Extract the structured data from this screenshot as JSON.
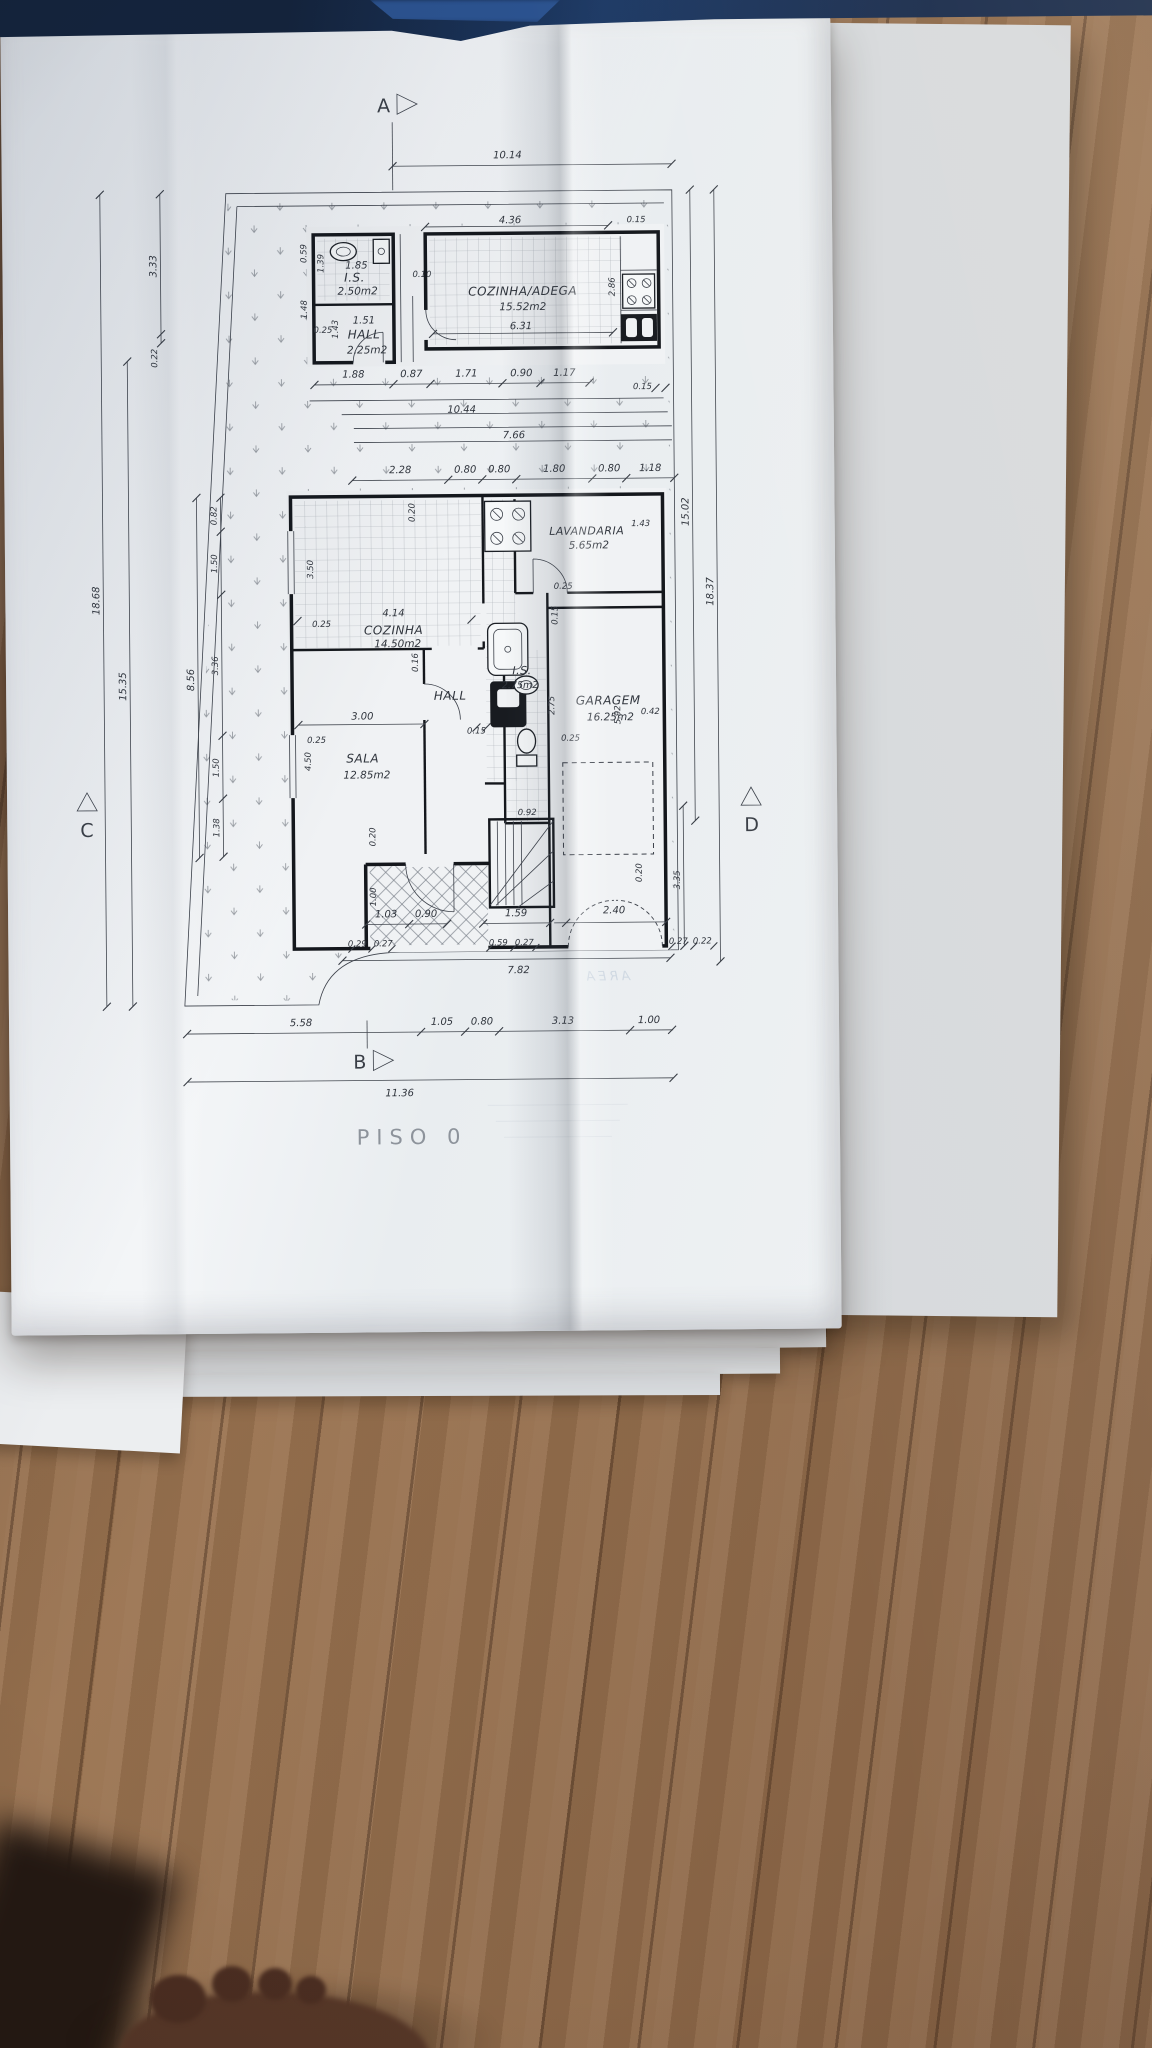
{
  "photo": {
    "cloth_color": "#1d3a66",
    "wood_color": "#936b4a",
    "paper_color": "#eef1f4",
    "ink_color": "#2e333b"
  },
  "plan": {
    "title": "PISO  0",
    "bleed_text": "AREA",
    "markers": {
      "top": "A",
      "bottom": "B",
      "left": "C",
      "right": "D"
    },
    "rooms": {
      "is_upper": {
        "name": "I.S.",
        "area": "2.50m2"
      },
      "hall_upper": {
        "name": "HALL",
        "area": "2.25m2"
      },
      "cozinha_adega": {
        "name": "COZINHA/ADEGA",
        "area": "15.52m2"
      },
      "cozinha": {
        "name": "COZINHA",
        "area": "14.50m2"
      },
      "lavandaria": {
        "name": "LAVANDARIA",
        "area": "5.65m2"
      },
      "hall": {
        "name": "HALL"
      },
      "is": {
        "name": "I.S.",
        "area": "2.75m2"
      },
      "sala": {
        "name": "SALA",
        "area": "12.85m2"
      },
      "garagem": {
        "name": "GARAGEM",
        "area": "16.25m2"
      }
    },
    "dims": {
      "top_width": "10.14",
      "row1": [
        "1.88",
        "0.87",
        "1.71",
        "0.90",
        "1.17"
      ],
      "row1_end": "0.15",
      "band_upper": "10.44",
      "band_lower": "7.66",
      "row2": [
        "2.28",
        "0.80",
        "0.80",
        "1.80",
        "0.80",
        "1.18"
      ],
      "upper_is_w": "1.85",
      "upper_is_h": "1.39",
      "upper_left_a": "0.59",
      "upper_left_b": "1.48",
      "upper_hall_w": "1.51",
      "upper_hall_h": "1.43",
      "upper_hall_off": "0.25",
      "gap_note": "0.10",
      "adega_w": "4.36",
      "adega_end": "0.15",
      "adega_h": "2.86",
      "adega_inner_w": "6.31",
      "left_total": "18.68",
      "left_lower": "15.35",
      "left_top": "3.33",
      "left_step": "0.22",
      "left_house": "8.56",
      "left_wall": [
        "0.82",
        "1.50",
        "3.36",
        "1.50",
        "1.38"
      ],
      "right_inner": "15.02",
      "right_total": "18.37",
      "right_lower": "3.35",
      "cozinha_top": "0.20",
      "cozinha_off": "0.25",
      "cozinha_w": "4.14",
      "cozinha_h": "3.50",
      "lavandaria_off": "0.25",
      "lavandaria_d": "1.43",
      "garagem_wall": "0.15",
      "is_h": "2.75",
      "is_w": "0.92",
      "sala_w": "3.00",
      "sala_gap": "0.15",
      "sala_off": "0.25",
      "garagem_off_l": "0.25",
      "sala_h": "4.50",
      "wall_thk": "0.16",
      "garagem_h": "5.92",
      "garagem_off": "0.42",
      "garage_door_off": "0.20",
      "porch_step": "0.20",
      "porch_d": "1.00",
      "row3": [
        "1.03",
        "0.90",
        "1.59",
        "2.40"
      ],
      "row4_l": [
        "0.29",
        "0.27"
      ],
      "row4_m": [
        "0.59",
        "0.27"
      ],
      "row4_r": [
        "0.27",
        "0.22"
      ],
      "bottom_inner": "7.82",
      "scale_row": [
        "5.58",
        "1.05",
        "0.80",
        "3.13",
        "1.00"
      ],
      "bottom_total": "11.36"
    }
  }
}
